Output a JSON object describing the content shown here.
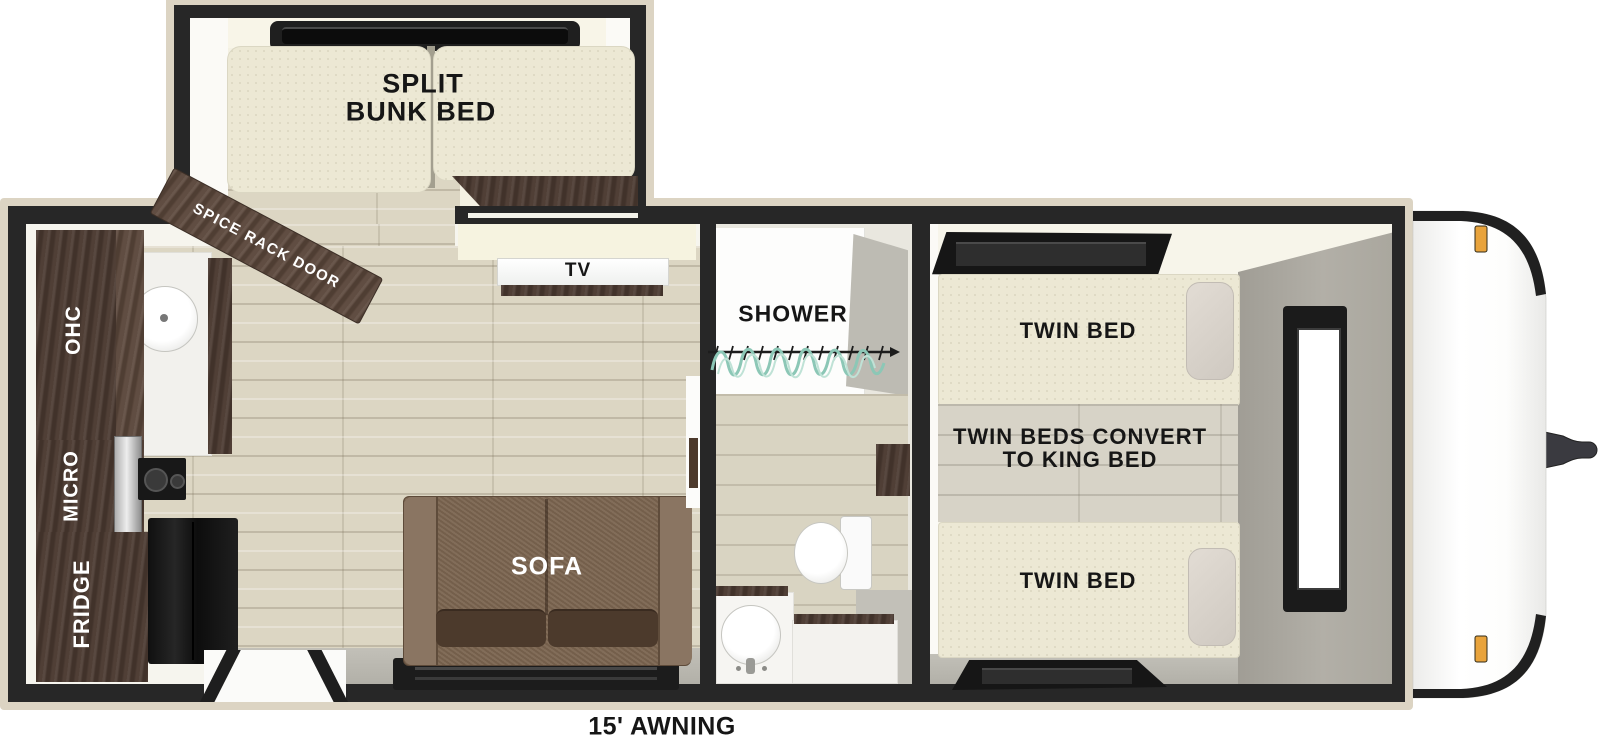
{
  "plan": {
    "awning": "15' AWNING",
    "slideout": {
      "split": "SPLIT",
      "bunk_bed": "BUNK BED",
      "spice_rack_door": "SPICE RACK DOOR"
    },
    "kitchen": {
      "ohc": "OHC",
      "micro": "MICRO",
      "fridge": "FRIDGE"
    },
    "living": {
      "tv": "TV",
      "sofa": "SOFA"
    },
    "bath": {
      "shower": "SHOWER"
    },
    "bedroom": {
      "twin_bed_rear": "TWIN BED",
      "twin_bed_front": "TWIN BED",
      "convert_line1": "TWIN BEDS CONVERT",
      "convert_line2": "TO KING BED"
    },
    "colors": {
      "wall": "#272727",
      "trim": "#dcd4c3",
      "dark_wood": "#4a3930",
      "floor_wood": "#dcd6c3",
      "mattress": "#ece8d4",
      "sofa": "#7b6550",
      "curtain": "#8cc7b6",
      "marker_light": "#e8a33c",
      "front_wall_gray": "#aaa79e"
    }
  }
}
